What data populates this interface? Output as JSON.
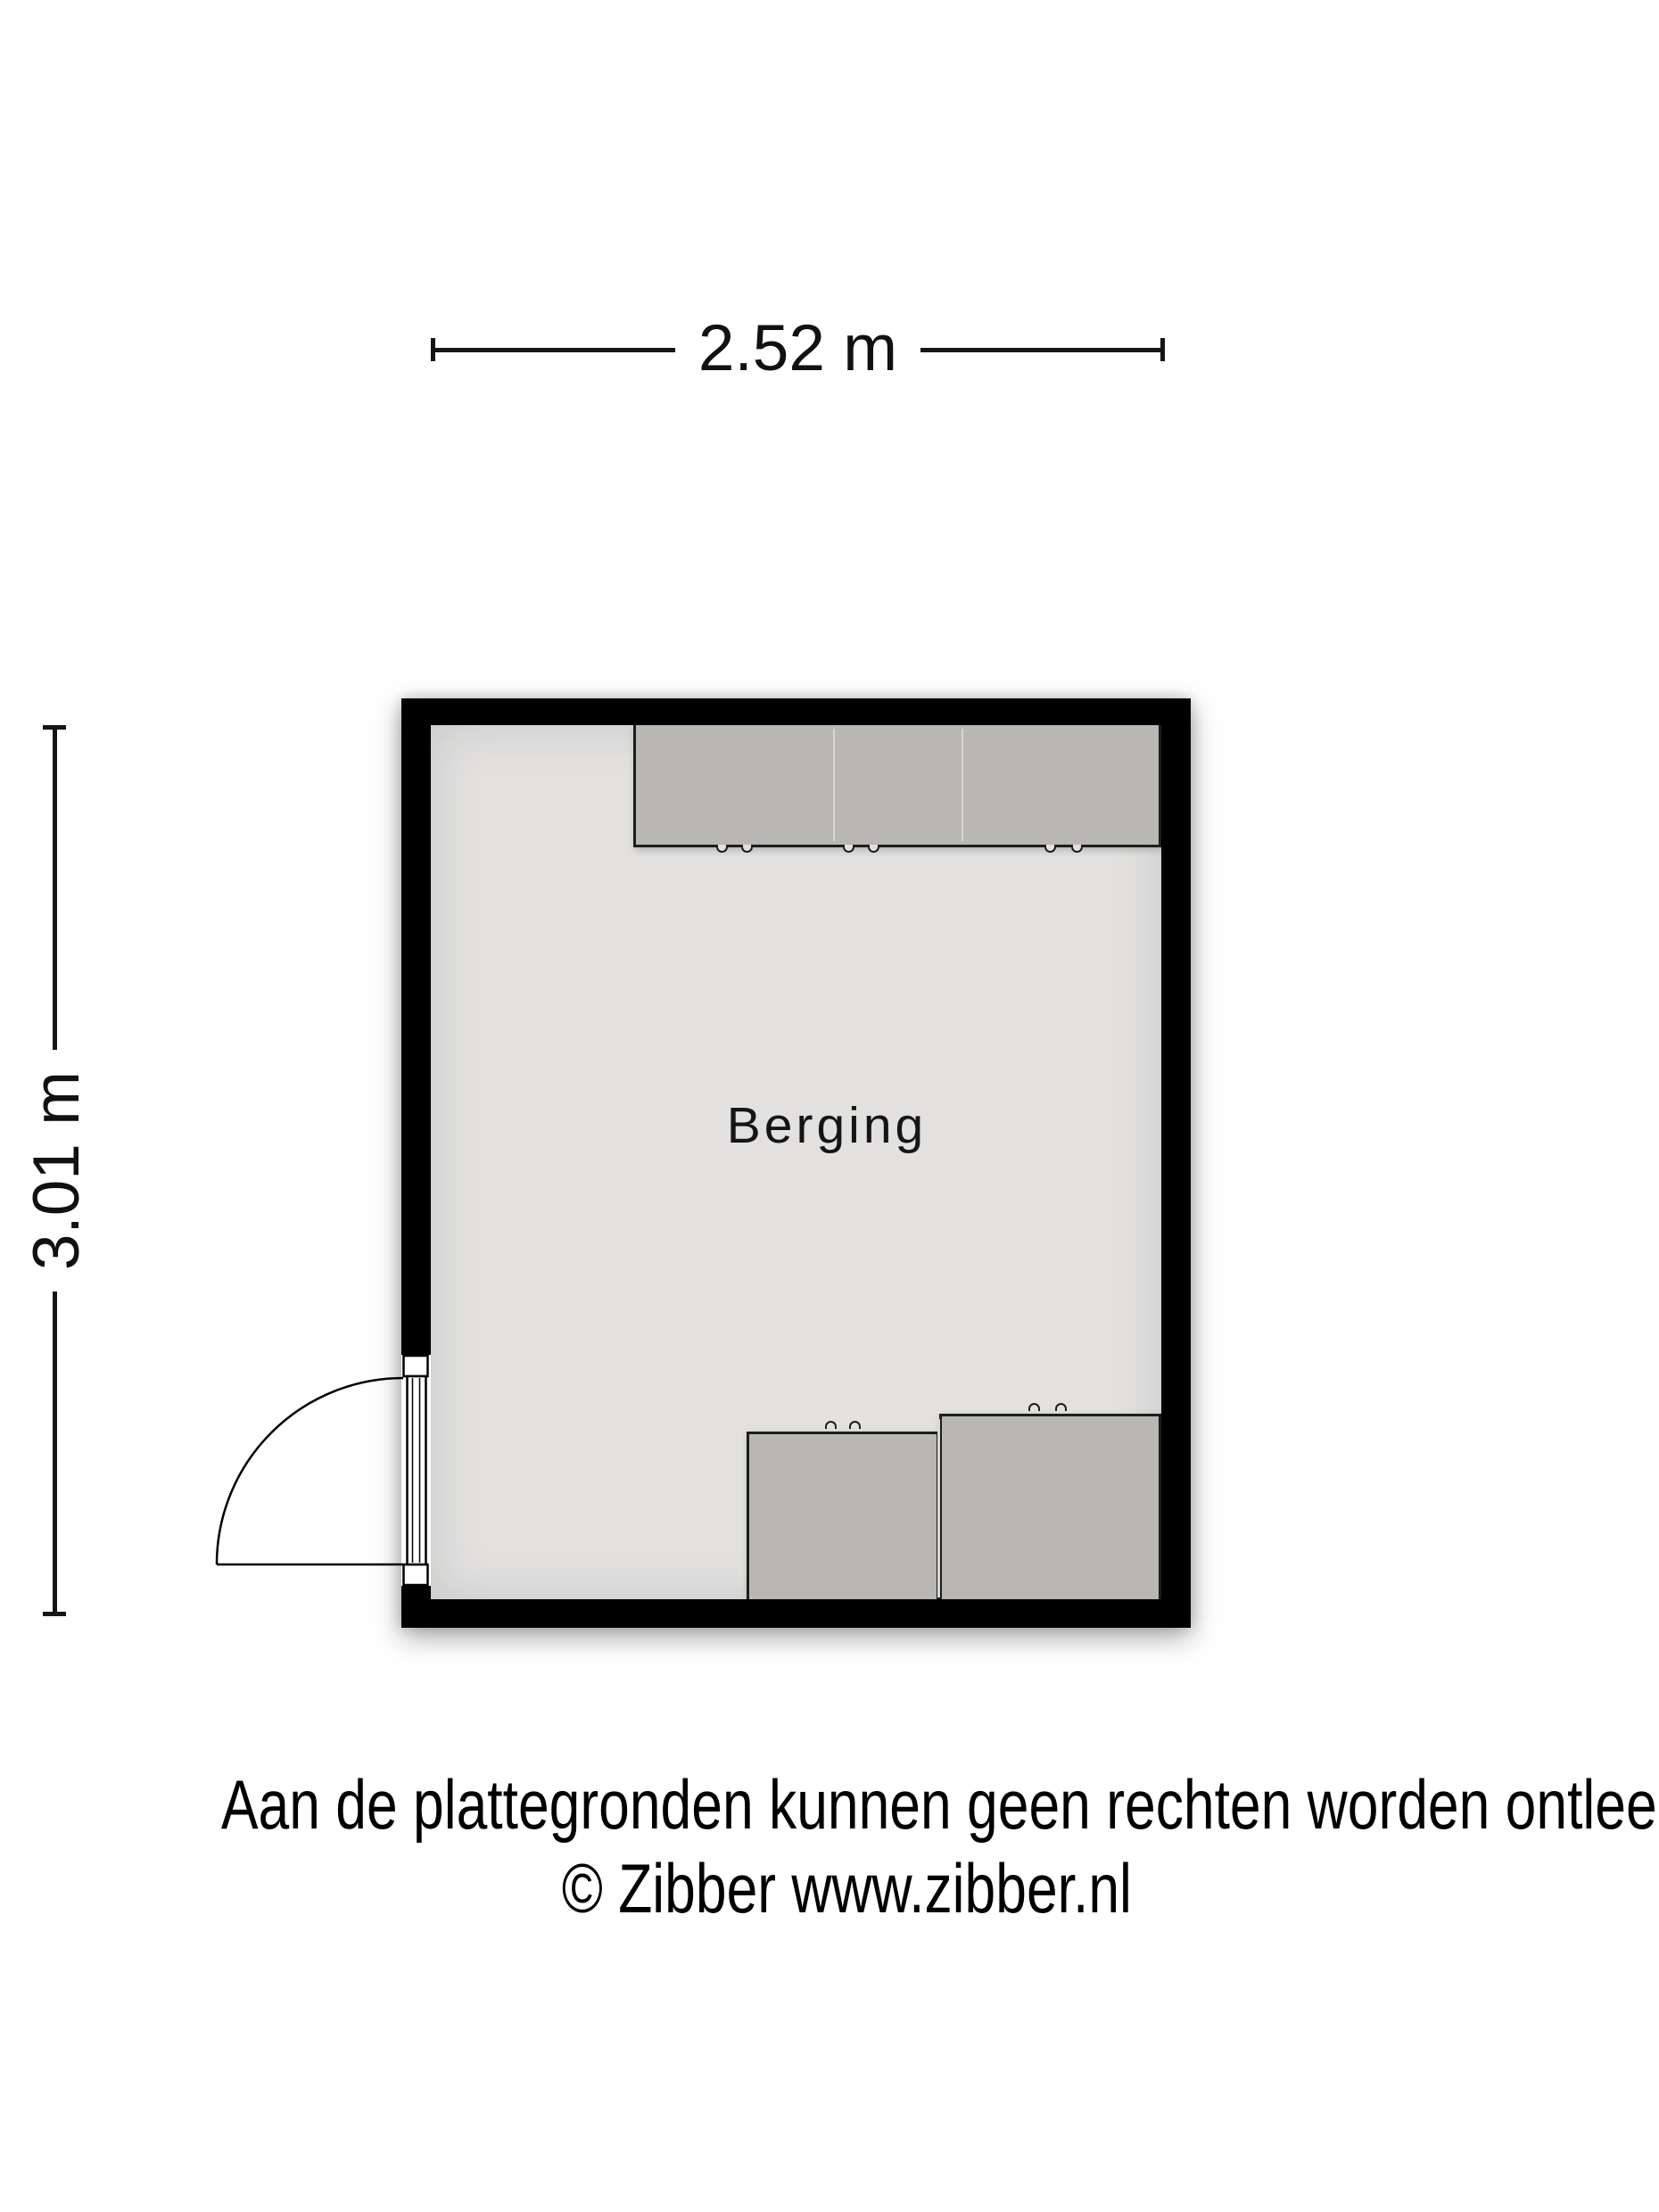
{
  "plan": {
    "room": {
      "label": "Berging"
    },
    "dimensions": {
      "width_label": "2.52 m",
      "height_label": "3.01 m"
    },
    "fixtures": {
      "top_cabinet_sections": 3,
      "bottom_cabinets": 2,
      "door": "hinged-left-wall-outward"
    }
  },
  "footer": {
    "disclaimer": "Aan de plattegronden kunnen geen rechten worden ontleend",
    "copyright": "© Zibber www.zibber.nl"
  },
  "colors": {
    "wall": "#000000",
    "floor": "#e2e1e0",
    "cabinet": "#b9b7b4",
    "outline": "#1d1d1b",
    "dimension": "#151515",
    "background": "#ffffff"
  }
}
